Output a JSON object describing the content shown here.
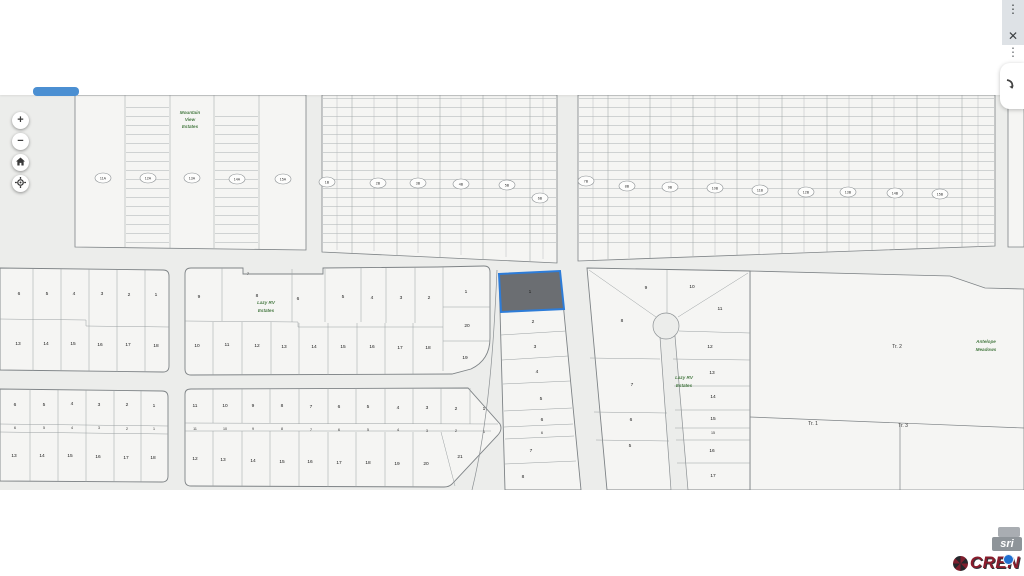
{
  "window": {
    "menu_icon": "⋮",
    "close_icon": "✕",
    "overflow_icon": "⋮"
  },
  "map_controls": {
    "zoom_in": "+",
    "zoom_out": "−"
  },
  "attribution": {
    "esri_text": "sri",
    "brand_text": "CREN"
  },
  "map": {
    "background": "#ecedeb",
    "parcel_fill": "#f5f5f3",
    "line_color": "#9aa0a2",
    "selected_parcel": {
      "label": "1",
      "fill": "#6b6e72",
      "border": "#2d7cd8"
    },
    "ovals": [
      [
        "11A",
        103,
        178
      ],
      [
        "12A",
        148,
        178
      ],
      [
        "13A",
        192,
        178
      ],
      [
        "14A",
        237,
        179
      ],
      [
        "15A",
        283,
        179
      ],
      [
        "1B",
        327,
        182
      ],
      [
        "2B",
        378,
        183
      ],
      [
        "3B",
        418,
        183
      ],
      [
        "4B",
        461,
        184
      ],
      [
        "5B",
        507,
        185
      ],
      [
        "6B",
        540,
        198
      ],
      [
        "7B",
        586,
        181
      ],
      [
        "8B",
        627,
        186
      ],
      [
        "9B",
        670,
        187
      ],
      [
        "10B",
        715,
        188
      ],
      [
        "11B",
        760,
        190
      ],
      [
        "12B",
        806,
        192
      ],
      [
        "13B",
        848,
        192
      ],
      [
        "14B",
        895,
        193
      ],
      [
        "15B",
        940,
        194
      ]
    ],
    "greens": [
      {
        "lines": [
          "Mountain",
          "View",
          "Estates"
        ],
        "x": 190,
        "y": 114,
        "gap": 7
      },
      {
        "lines": [
          "Lazy RV",
          "Estates"
        ],
        "x": 266,
        "y": 304,
        "gap": 8
      },
      {
        "lines": [
          "Lazy RV",
          "Estates"
        ],
        "x": 684,
        "y": 379,
        "gap": 8
      },
      {
        "lines": [
          "Antelope",
          "Meadows"
        ],
        "x": 986,
        "y": 343,
        "gap": 8
      }
    ],
    "texts": [
      [
        "6",
        19,
        295
      ],
      [
        "5",
        47,
        295
      ],
      [
        "4",
        74,
        295
      ],
      [
        "3",
        102,
        295
      ],
      [
        "2",
        129,
        296
      ],
      [
        "1",
        156,
        296
      ],
      [
        "13",
        18,
        345
      ],
      [
        "14",
        46,
        345
      ],
      [
        "15",
        73,
        345
      ],
      [
        "16",
        100,
        346
      ],
      [
        "17",
        128,
        346
      ],
      [
        "18",
        156,
        347
      ],
      [
        "7",
        248,
        275,
        "tiny"
      ],
      [
        "9",
        199,
        298
      ],
      [
        "8",
        257,
        297
      ],
      [
        "6",
        298,
        300
      ],
      [
        "5",
        343,
        298
      ],
      [
        "4",
        372,
        299
      ],
      [
        "3",
        401,
        299
      ],
      [
        "2",
        429,
        299
      ],
      [
        "1",
        466,
        293
      ],
      [
        "20",
        467,
        327
      ],
      [
        "19",
        465,
        359
      ],
      [
        "10",
        197,
        347
      ],
      [
        "11",
        227,
        346
      ],
      [
        "12",
        257,
        347
      ],
      [
        "13",
        284,
        348
      ],
      [
        "14",
        314,
        348
      ],
      [
        "15",
        343,
        348
      ],
      [
        "16",
        372,
        348
      ],
      [
        "17",
        400,
        349
      ],
      [
        "18",
        428,
        349
      ],
      [
        "6",
        15,
        406
      ],
      [
        "5",
        44,
        406
      ],
      [
        "4",
        72,
        405
      ],
      [
        "3",
        99,
        406
      ],
      [
        "2",
        127,
        406
      ],
      [
        "1",
        154,
        407
      ],
      [
        "6",
        15,
        429,
        "tiny"
      ],
      [
        "5",
        44,
        429,
        "tiny"
      ],
      [
        "4",
        72,
        429,
        "tiny"
      ],
      [
        "3",
        99,
        429,
        "tiny"
      ],
      [
        "2",
        127,
        430,
        "tiny"
      ],
      [
        "1",
        154,
        430,
        "tiny"
      ],
      [
        "13",
        14,
        457
      ],
      [
        "14",
        42,
        457
      ],
      [
        "15",
        70,
        457
      ],
      [
        "16",
        98,
        458
      ],
      [
        "17",
        126,
        459
      ],
      [
        "18",
        153,
        459
      ],
      [
        "11",
        195,
        407
      ],
      [
        "10",
        225,
        407
      ],
      [
        "9",
        253,
        407
      ],
      [
        "8",
        282,
        407
      ],
      [
        "7",
        311,
        408
      ],
      [
        "6",
        339,
        408
      ],
      [
        "5",
        368,
        408
      ],
      [
        "4",
        398,
        409
      ],
      [
        "3",
        427,
        409
      ],
      [
        "2",
        456,
        410
      ],
      [
        "1",
        484,
        410
      ],
      [
        "11",
        195,
        430,
        "tiny"
      ],
      [
        "10",
        225,
        430,
        "tiny"
      ],
      [
        "9",
        253,
        430,
        "tiny"
      ],
      [
        "8",
        282,
        430,
        "tiny"
      ],
      [
        "7",
        311,
        431,
        "tiny"
      ],
      [
        "6",
        339,
        431,
        "tiny"
      ],
      [
        "5",
        368,
        431,
        "tiny"
      ],
      [
        "4",
        398,
        431,
        "tiny"
      ],
      [
        "3",
        427,
        432,
        "tiny"
      ],
      [
        "2",
        456,
        432,
        "tiny"
      ],
      [
        "1",
        484,
        433,
        "tiny"
      ],
      [
        "12",
        195,
        460
      ],
      [
        "13",
        223,
        461
      ],
      [
        "14",
        253,
        462
      ],
      [
        "15",
        282,
        463
      ],
      [
        "16",
        310,
        463
      ],
      [
        "17",
        339,
        464
      ],
      [
        "18",
        368,
        464
      ],
      [
        "19",
        397,
        465
      ],
      [
        "20",
        426,
        465
      ],
      [
        "21",
        460,
        458
      ],
      [
        "1",
        530,
        293
      ],
      [
        "2",
        533,
        323
      ],
      [
        "3",
        535,
        348
      ],
      [
        "4",
        537,
        373
      ],
      [
        "5",
        541,
        400
      ],
      [
        "6",
        542,
        421
      ],
      [
        "6",
        542,
        434,
        "tiny"
      ],
      [
        "7",
        531,
        452
      ],
      [
        "8",
        523,
        478
      ],
      [
        "9",
        646,
        289
      ],
      [
        "10",
        692,
        288
      ],
      [
        "8",
        622,
        322
      ],
      [
        "11",
        720,
        310
      ],
      [
        "12",
        710,
        348
      ],
      [
        "13",
        712,
        374
      ],
      [
        "7",
        632,
        386
      ],
      [
        "14",
        713,
        398
      ],
      [
        "15",
        713,
        420
      ],
      [
        "6",
        631,
        421
      ],
      [
        "15",
        713,
        434,
        "tiny"
      ],
      [
        "5",
        630,
        447
      ],
      [
        "16",
        712,
        452
      ],
      [
        "17",
        713,
        477
      ],
      [
        "Tr. 2",
        897,
        348,
        "tract"
      ],
      [
        "Tr. 1",
        813,
        425,
        "tract"
      ],
      [
        "Tr. 3",
        903,
        427,
        "tract"
      ]
    ]
  }
}
